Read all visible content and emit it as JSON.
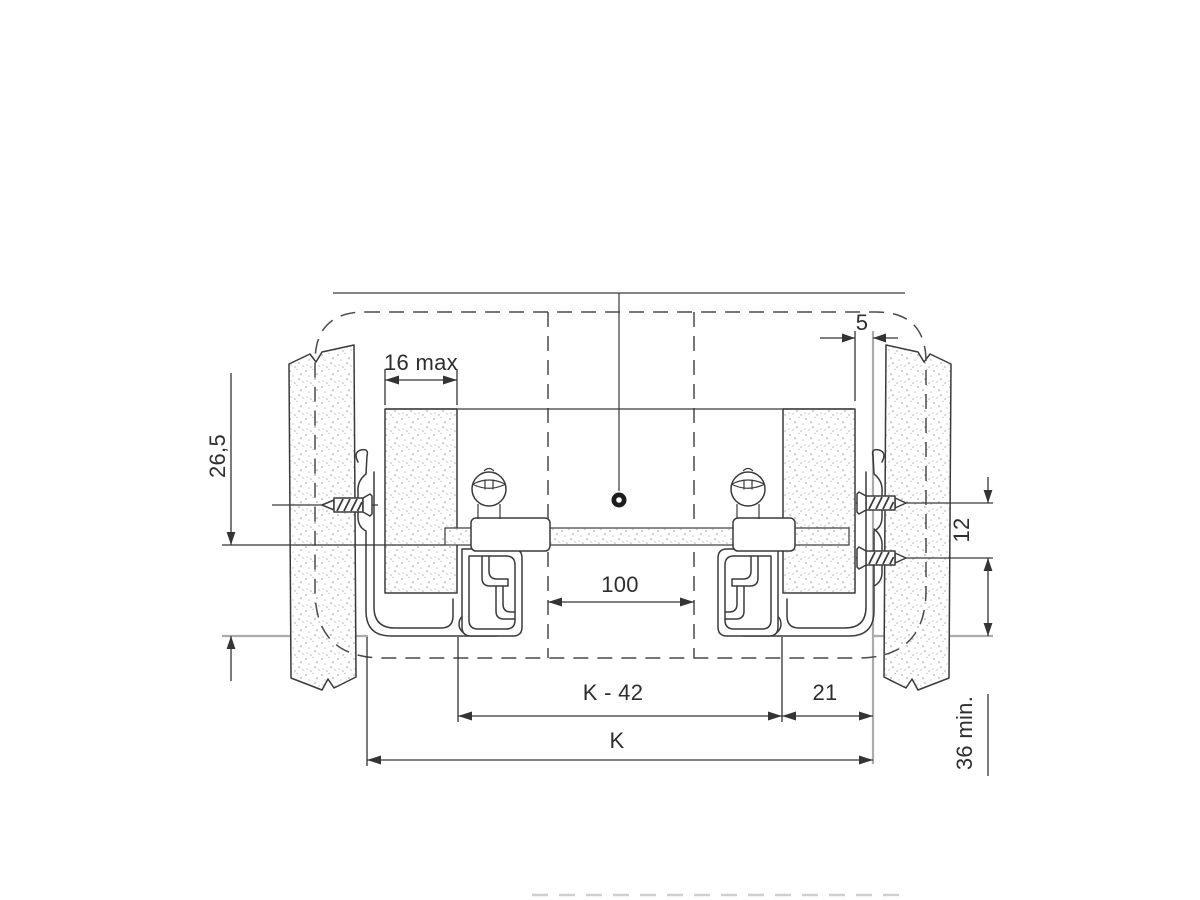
{
  "diagram": {
    "description": "Drawer runner mounting cross-section installation drawing",
    "dimension_labels": {
      "drawer_side_max_thickness": "16 max",
      "side_clearance": "5",
      "runner_height": "26,5",
      "screw_pitch": "12",
      "center_hole_pitch": "100",
      "inner_width_formula": "K - 42",
      "runner_to_side": "21",
      "overall_width": "K",
      "minimum_clearance": "36 min."
    },
    "colors": {
      "line": "#3a3a3a",
      "reference_gray": "#ababab",
      "stipple_dot": "#9b9b9b",
      "background": "#ffffff"
    }
  }
}
